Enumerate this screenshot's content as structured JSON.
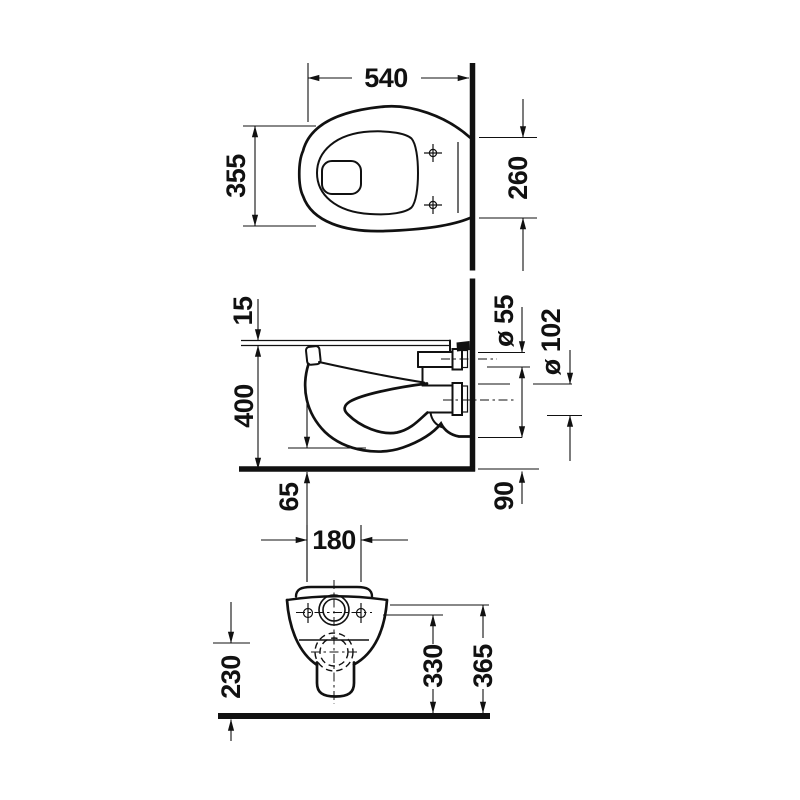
{
  "labels": {
    "top": {
      "width": "540",
      "depth": "355",
      "rear_width": "260"
    },
    "side": {
      "seat_thickness": "15",
      "rim_height": "400",
      "bowl_clearance": "65",
      "inlet_diameter": "ø 55",
      "outlet_diameter": "ø 102",
      "outlet_height": "90"
    },
    "front": {
      "bolt_spacing": "180",
      "side_height": "230",
      "outlet_center_height": "330",
      "top_height": "365"
    }
  }
}
